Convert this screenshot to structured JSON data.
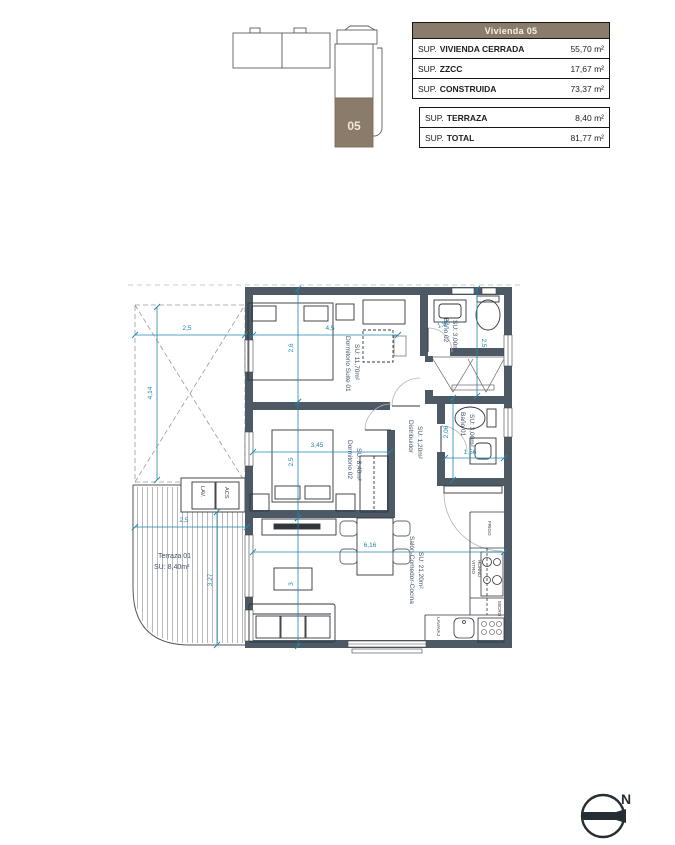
{
  "summary": {
    "title": "Vivienda 05",
    "header_bg": "#8a7b6a",
    "table1_rows": [
      {
        "prefix": "SUP.",
        "label": "VIVIENDA CERRADA",
        "value": "55,70 m²"
      },
      {
        "prefix": "SUP.",
        "label": "ZZCC",
        "value": "17,67 m²"
      },
      {
        "prefix": "SUP.",
        "label": "CONSTRUIDA",
        "value": "73,37 m²"
      }
    ],
    "table2_rows": [
      {
        "prefix": "SUP.",
        "label": "TERRAZA",
        "value": "8,40 m²"
      },
      {
        "prefix": "SUP.",
        "label": "TOTAL",
        "value": "81,77 m²"
      }
    ]
  },
  "key_plan": {
    "unit_label": "05",
    "unit_color": "#8a7b6a"
  },
  "compass": {
    "label": "N"
  },
  "plan": {
    "colors": {
      "wall": "#4d5964",
      "dim": "#1f86ac",
      "room_label": "#42526b"
    },
    "rooms": {
      "suite": {
        "name": "Dormitorio Suite 01",
        "area": "SU: 11,70m²"
      },
      "bano02": {
        "name": "Baño 02",
        "area": "SU: 3,00m²"
      },
      "bano01": {
        "name": "Baño 01",
        "area": "SU: 3,00m²"
      },
      "distribuidor": {
        "name": "Distribuidor",
        "area": "SU: 1,20m²"
      },
      "dorm02": {
        "name": "Dormitorio 02",
        "area": "SU: 8,40m²"
      },
      "salon": {
        "name": "Salón-Comedor-Cocina",
        "area": "SU: 21,20m²"
      },
      "terraza": {
        "name": "Terraza 01",
        "area": "SU: 8,40m²"
      }
    },
    "fixtures": {
      "frigo": "FRIGO",
      "vitro": "VITRO",
      "horno": "HORNO",
      "micro": "MICRO",
      "lavavaj": "LAVAVAJ",
      "lav": "LAV.",
      "acs": "ACS"
    },
    "dimensions": [
      {
        "x1": 135,
        "y1": 335,
        "x2": 245,
        "y2": 335,
        "t": "2,5",
        "tx": 187,
        "ty": 330,
        "rot": 0
      },
      {
        "x1": 253,
        "y1": 335,
        "x2": 398,
        "y2": 335,
        "t": "4,5",
        "tx": 330,
        "ty": 330,
        "rot": 0
      },
      {
        "x1": 157,
        "y1": 307,
        "x2": 157,
        "y2": 480,
        "t": "4,14",
        "tx": 152,
        "ty": 393,
        "rot": -90
      },
      {
        "x1": 298,
        "y1": 289,
        "x2": 298,
        "y2": 402,
        "t": "2,6",
        "tx": 293,
        "ty": 348,
        "rot": -90
      },
      {
        "x1": 298,
        "y1": 402,
        "x2": 298,
        "y2": 518,
        "t": "2,5",
        "tx": 293,
        "ty": 462,
        "rot": -90
      },
      {
        "x1": 298,
        "y1": 518,
        "x2": 298,
        "y2": 646,
        "t": "3",
        "tx": 293,
        "ty": 584,
        "rot": -90
      },
      {
        "x1": 253,
        "y1": 452,
        "x2": 390,
        "y2": 452,
        "t": "3,45",
        "tx": 317,
        "ty": 447,
        "rot": 0
      },
      {
        "x1": 253,
        "y1": 552,
        "x2": 504,
        "y2": 552,
        "t": "6,16",
        "tx": 370,
        "ty": 547,
        "rot": 0
      },
      {
        "x1": 135,
        "y1": 527,
        "x2": 247,
        "y2": 527,
        "t": "2,5",
        "tx": 184,
        "ty": 522,
        "rot": 0
      },
      {
        "x1": 217,
        "y1": 512,
        "x2": 217,
        "y2": 645,
        "t": "3,27",
        "tx": 212,
        "ty": 580,
        "rot": -90
      },
      {
        "x1": 477,
        "y1": 289,
        "x2": 477,
        "y2": 396,
        "t": "2,5",
        "tx": 482,
        "ty": 343,
        "rot": 90
      },
      {
        "x1": 453,
        "y1": 398,
        "x2": 453,
        "y2": 480,
        "t": "2,06",
        "tx": 448,
        "ty": 432,
        "rot": -90
      },
      {
        "x1": 445,
        "y1": 458,
        "x2": 504,
        "y2": 458,
        "t": "1,56",
        "tx": 470,
        "ty": 454,
        "rot": 0
      },
      {
        "t": "1,56",
        "tx": 444,
        "ty": 326,
        "rot": -18
      }
    ]
  }
}
